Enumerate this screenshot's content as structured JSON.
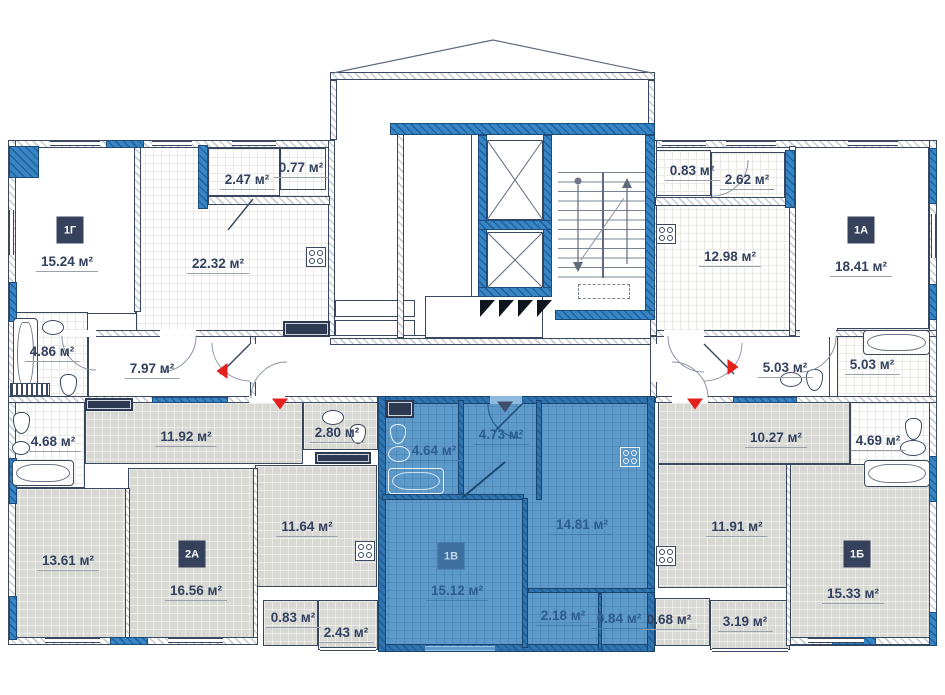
{
  "colors": {
    "highlight": "#5d99c9",
    "wall_blue": "#2f7cba",
    "label": "#33415f",
    "label_blue": "#2d5d90",
    "badge_bg": "#36415b",
    "marker_red": "#e3201b",
    "marker_dark": "#414d6b"
  },
  "units": [
    {
      "code": "1Г",
      "highlighted": false,
      "badge": {
        "x": 70,
        "y": 230
      },
      "rooms": [
        {
          "area": "15.24 м²",
          "x": 67,
          "y": 263
        },
        {
          "area": "22.32 м²",
          "x": 218,
          "y": 265
        },
        {
          "area": "2.47 м²",
          "x": 247,
          "y": 181
        },
        {
          "area": "0.77 м²",
          "x": 301,
          "y": 169
        },
        {
          "area": "4.86 м²",
          "x": 52,
          "y": 353
        },
        {
          "area": "7.97 м²",
          "x": 152,
          "y": 370
        }
      ]
    },
    {
      "code": "1А",
      "highlighted": false,
      "badge": {
        "x": 861,
        "y": 230
      },
      "rooms": [
        {
          "area": "0.83 м²",
          "x": 692,
          "y": 172
        },
        {
          "area": "2.62 м²",
          "x": 747,
          "y": 181
        },
        {
          "area": "12.98 м²",
          "x": 730,
          "y": 258
        },
        {
          "area": "18.41 м²",
          "x": 861,
          "y": 268
        },
        {
          "area": "5.03 м²",
          "x": 785,
          "y": 369
        },
        {
          "area": "5.03 м²",
          "x": 872,
          "y": 366
        }
      ]
    },
    {
      "code": "2А",
      "highlighted": false,
      "badge": {
        "x": 192,
        "y": 554
      },
      "rooms": [
        {
          "area": "4.68 м²",
          "x": 53,
          "y": 443
        },
        {
          "area": "11.92 м²",
          "x": 186,
          "y": 438
        },
        {
          "area": "2.80 м²",
          "x": 337,
          "y": 434
        },
        {
          "area": "13.61 м²",
          "x": 68,
          "y": 562
        },
        {
          "area": "16.56 м²",
          "x": 196,
          "y": 592
        },
        {
          "area": "11.64 м²",
          "x": 307,
          "y": 528
        },
        {
          "area": "0.83 м²",
          "x": 293,
          "y": 619
        },
        {
          "area": "2.43 м²",
          "x": 346,
          "y": 634
        }
      ]
    },
    {
      "code": "1В",
      "highlighted": true,
      "badge": {
        "x": 451,
        "y": 556
      },
      "rooms": [
        {
          "area": "4.64 м²",
          "x": 434,
          "y": 452
        },
        {
          "area": "4.73 м²",
          "x": 501,
          "y": 436
        },
        {
          "area": "14.81 м²",
          "x": 582,
          "y": 526
        },
        {
          "area": "15.12 м²",
          "x": 457,
          "y": 592
        },
        {
          "area": "2.18 м²",
          "x": 563,
          "y": 617
        },
        {
          "area": "0.84 м²",
          "x": 619,
          "y": 620
        }
      ]
    },
    {
      "code": "1Б",
      "highlighted": false,
      "badge": {
        "x": 857,
        "y": 554
      },
      "rooms": [
        {
          "area": "10.27 м²",
          "x": 776,
          "y": 439
        },
        {
          "area": "4.69 м²",
          "x": 878,
          "y": 442
        },
        {
          "area": "11.91 м²",
          "x": 737,
          "y": 528
        },
        {
          "area": "15.33 м²",
          "x": 853,
          "y": 595
        },
        {
          "area": "0.68 м²",
          "x": 669,
          "y": 621
        },
        {
          "area": "3.19 м²",
          "x": 745,
          "y": 623
        }
      ]
    }
  ],
  "markers": [
    {
      "dir": "left",
      "x": 222,
      "y": 371,
      "variant": "red"
    },
    {
      "dir": "down",
      "x": 280,
      "y": 404,
      "variant": "red"
    },
    {
      "dir": "down",
      "x": 505,
      "y": 407,
      "variant": "dark"
    },
    {
      "dir": "down",
      "x": 695,
      "y": 404,
      "variant": "red"
    },
    {
      "dir": "right",
      "x": 733,
      "y": 367,
      "variant": "red"
    }
  ]
}
